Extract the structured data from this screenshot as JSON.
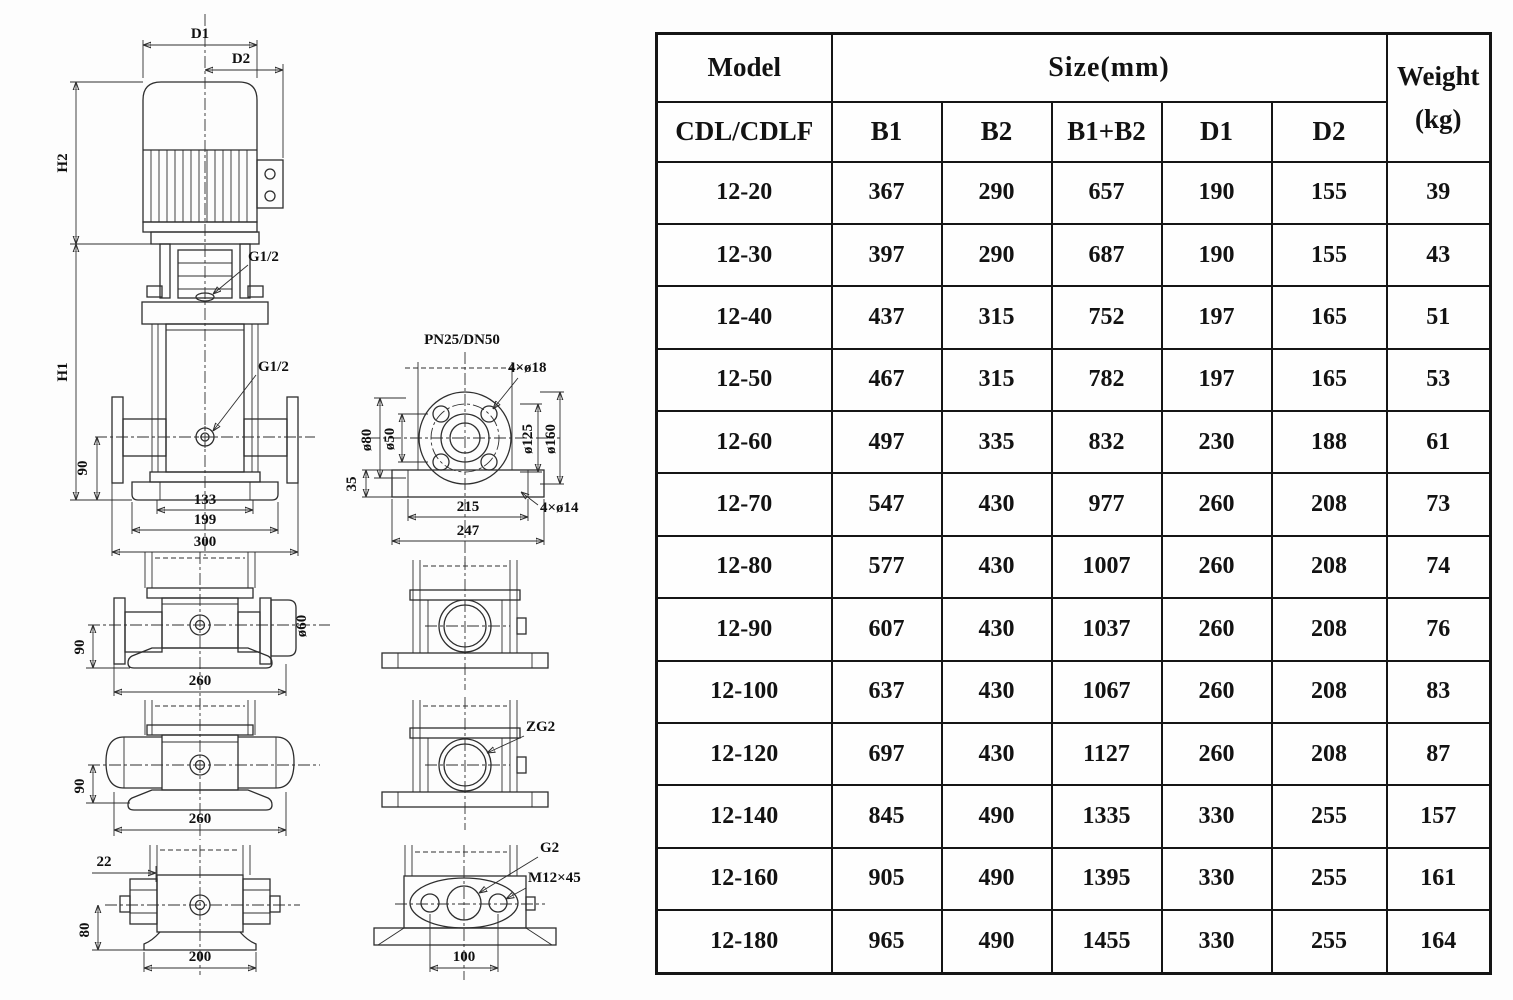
{
  "table": {
    "header": {
      "model": "Model",
      "model_sub": "CDL/CDLF",
      "size_group": "Size(mm)",
      "columns": [
        "B1",
        "B2",
        "B1+B2",
        "D1",
        "D2"
      ],
      "weight_line1": "Weight",
      "weight_line2": "(kg)"
    },
    "rows": [
      [
        "12-20",
        "367",
        "290",
        "657",
        "190",
        "155",
        "39"
      ],
      [
        "12-30",
        "397",
        "290",
        "687",
        "190",
        "155",
        "43"
      ],
      [
        "12-40",
        "437",
        "315",
        "752",
        "197",
        "165",
        "51"
      ],
      [
        "12-50",
        "467",
        "315",
        "782",
        "197",
        "165",
        "53"
      ],
      [
        "12-60",
        "497",
        "335",
        "832",
        "230",
        "188",
        "61"
      ],
      [
        "12-70",
        "547",
        "430",
        "977",
        "260",
        "208",
        "73"
      ],
      [
        "12-80",
        "577",
        "430",
        "1007",
        "260",
        "208",
        "74"
      ],
      [
        "12-90",
        "607",
        "430",
        "1037",
        "260",
        "208",
        "76"
      ],
      [
        "12-100",
        "637",
        "430",
        "1067",
        "260",
        "208",
        "83"
      ],
      [
        "12-120",
        "697",
        "430",
        "1127",
        "260",
        "208",
        "87"
      ],
      [
        "12-140",
        "845",
        "490",
        "1335",
        "330",
        "255",
        "157"
      ],
      [
        "12-160",
        "905",
        "490",
        "1395",
        "330",
        "255",
        "161"
      ],
      [
        "12-180",
        "965",
        "490",
        "1455",
        "330",
        "255",
        "164"
      ]
    ]
  },
  "drawings": {
    "front_view": {
      "dim_d1": "D1",
      "dim_d2": "D2",
      "dim_h2": "H2",
      "dim_h1": "H1",
      "port_label_top": "G1/2",
      "port_label_mid": "G1/2",
      "dim_90": "90",
      "dim_133": "133",
      "dim_199": "199",
      "dim_300": "300"
    },
    "flange_top_view": {
      "title": "PN25/DN50",
      "bolt_holes": "4×ø18",
      "dia_80": "ø80",
      "dia_50": "ø50",
      "dia_125": "ø125",
      "dia_160": "ø160",
      "dim_35": "35",
      "dim_215": "215",
      "dim_247": "247",
      "base_holes": "4×ø14"
    },
    "side_view_flanged": {
      "dim_90": "90",
      "dim_260": "260",
      "dia_60": "ø60"
    },
    "side_view_round": {
      "dim_90": "90",
      "dim_260": "260"
    },
    "base_view": {
      "dim_22": "22",
      "dim_80": "80",
      "dim_200": "200"
    },
    "port_view_zg2": {
      "port_label": "ZG2"
    },
    "oval_flange_view": {
      "port_label": "G2",
      "bolt_label": "M12×45",
      "dim_100": "100"
    }
  }
}
